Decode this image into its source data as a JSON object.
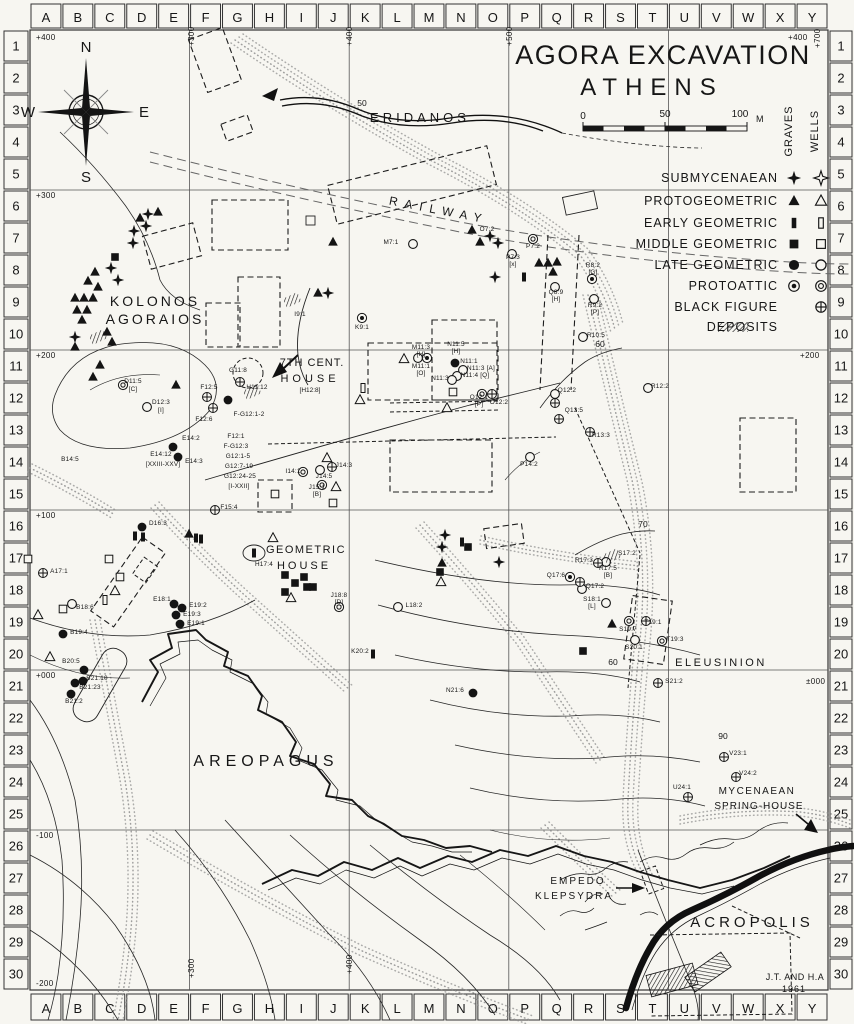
{
  "title": {
    "line1": "AGORA EXCAVATION",
    "line2": "ATHENS"
  },
  "credit": {
    "line1": "J.T. AND H.A",
    "line2": "1961"
  },
  "scale_bar": {
    "t0": "0",
    "t50": "50",
    "t100": "100",
    "unit": "M"
  },
  "compass": {
    "n": "N",
    "s": "S",
    "e": "E",
    "w": "W"
  },
  "grid": {
    "columns": [
      "A",
      "B",
      "C",
      "D",
      "E",
      "F",
      "G",
      "H",
      "I",
      "J",
      "K",
      "L",
      "M",
      "N",
      "O",
      "P",
      "Q",
      "R",
      "S",
      "T",
      "U",
      "V",
      "W",
      "X",
      "Y"
    ],
    "rows": [
      "1",
      "2",
      "3",
      "4",
      "5",
      "6",
      "7",
      "8",
      "9",
      "10",
      "11",
      "12",
      "13",
      "14",
      "15",
      "16",
      "17",
      "18",
      "19",
      "20",
      "21",
      "22",
      "23",
      "24",
      "25",
      "26",
      "27",
      "28",
      "29",
      "30"
    ]
  },
  "legend": {
    "col_headers": [
      "GRAVES",
      "WELLS"
    ],
    "rows": [
      {
        "label": "SUBMYCENAEAN",
        "graves": "sm",
        "wells": "smo"
      },
      {
        "label": "PROTOGEOMETRIC",
        "graves": "pg",
        "wells": "pgo"
      },
      {
        "label": "EARLY GEOMETRIC",
        "graves": "eg",
        "wells": "ego"
      },
      {
        "label": "MIDDLE GEOMETRIC",
        "graves": "mg",
        "wells": "mgo"
      },
      {
        "label": "LATE GEOMETRIC",
        "graves": "lg",
        "wells": "lgo"
      },
      {
        "label": "PROTOATTIC",
        "graves": "pa",
        "wells": "pao"
      },
      {
        "label": "BLACK FIGURE",
        "graves": null,
        "wells": "bf"
      },
      {
        "label": "DEPOSITS",
        "graves": "hatch",
        "wells": null
      }
    ]
  },
  "place_labels": [
    {
      "text": "ERIDANOS",
      "x": 420,
      "y": 122,
      "size": 13,
      "ls": 4
    },
    {
      "text": "RAILWAY",
      "x": 438,
      "y": 214,
      "size": 12,
      "ls": 7,
      "rot": 11
    },
    {
      "text": "KOLONOS",
      "x": 155,
      "y": 306,
      "size": 14,
      "ls": 3
    },
    {
      "text": "AGORAIOS",
      "x": 155,
      "y": 324,
      "size": 14,
      "ls": 3
    },
    {
      "text": "7TH CENT.",
      "x": 312,
      "y": 366,
      "size": 11,
      "ls": 1
    },
    {
      "text": "HOUSE",
      "x": 310,
      "y": 382,
      "size": 11,
      "ls": 4
    },
    {
      "text": "[H12:8]",
      "x": 310,
      "y": 392,
      "size": 6.5,
      "ls": 0
    },
    {
      "text": "GEOMETRIC",
      "x": 306,
      "y": 553,
      "size": 11,
      "ls": 1.5
    },
    {
      "text": "HOUSE",
      "x": 304,
      "y": 569,
      "size": 11,
      "ls": 3
    },
    {
      "text": "AREOPAGUS",
      "x": 266,
      "y": 766,
      "size": 16,
      "ls": 5
    },
    {
      "text": "ELEUSINION",
      "x": 721,
      "y": 666,
      "size": 11,
      "ls": 2.5
    },
    {
      "text": "MYCENAEAN",
      "x": 757,
      "y": 794,
      "size": 10,
      "ls": 1.5
    },
    {
      "text": "SPRING-HOUSE",
      "x": 759,
      "y": 809,
      "size": 10,
      "ls": 1
    },
    {
      "text": "EMPEDO",
      "x": 578,
      "y": 884,
      "size": 10,
      "ls": 2
    },
    {
      "text": "KLEPSYDRA",
      "x": 574,
      "y": 899,
      "size": 10,
      "ls": 2
    },
    {
      "text": "ACROPOLIS",
      "x": 752,
      "y": 927,
      "size": 15,
      "ls": 4
    },
    {
      "text": "GRAVES",
      "x": 792,
      "y": 131,
      "size": 11,
      "ls": 1,
      "rot": -90
    },
    {
      "text": "WELLS",
      "x": 818,
      "y": 131,
      "size": 11,
      "ls": 1,
      "rot": -90
    }
  ],
  "point_labels": [
    [
      "D11:5",
      133,
      383
    ],
    [
      "[C]",
      133,
      391
    ],
    [
      "D12:3",
      161,
      404
    ],
    [
      "[I]",
      161,
      412
    ],
    [
      "B14:5",
      70,
      461
    ],
    [
      "E14:2",
      191,
      440
    ],
    [
      "E14:12",
      161,
      456
    ],
    [
      "[XXIII-XXV]",
      163,
      466
    ],
    [
      "E14:3",
      194,
      463
    ],
    [
      "F12:5",
      209,
      389
    ],
    [
      "F12:6",
      204,
      421
    ],
    [
      "F-G12:1-2",
      249,
      416
    ],
    [
      "G11:8",
      238,
      372
    ],
    [
      "F12:1",
      236,
      438
    ],
    [
      "F-G12:3",
      236,
      448
    ],
    [
      "G12:1-5",
      238,
      458
    ],
    [
      "G12:7-19",
      239,
      468
    ],
    [
      "G12:24-25",
      240,
      478
    ],
    [
      "[I-XXII]",
      239,
      488
    ],
    [
      "F15:4",
      229,
      509
    ],
    [
      "H11:12",
      257,
      389
    ],
    [
      "I14:1",
      293,
      473
    ],
    [
      "J14:5",
      324,
      478
    ],
    [
      "J14:3",
      344,
      467
    ],
    [
      "J15:1",
      317,
      489
    ],
    [
      "[B]",
      317,
      496
    ],
    [
      "D16:3",
      158,
      525
    ],
    [
      "H17:4",
      264,
      566
    ],
    [
      "J18:8",
      339,
      597
    ],
    [
      "[D]",
      339,
      604
    ],
    [
      "E18:1",
      162,
      601
    ],
    [
      "E19:2",
      198,
      607
    ],
    [
      "E19:3",
      192,
      616
    ],
    [
      "E19:1",
      196,
      625
    ],
    [
      "K20:2",
      360,
      653
    ],
    [
      "B18:6",
      85,
      609
    ],
    [
      "A17:1",
      59,
      573
    ],
    [
      "B19:4",
      79,
      634
    ],
    [
      "B20:5",
      71,
      663
    ],
    [
      "B21:10",
      97,
      680
    ],
    [
      "B21:23",
      90,
      689
    ],
    [
      "B21:2",
      74,
      703
    ],
    [
      "L18:2",
      414,
      607
    ],
    [
      "N21:6",
      455,
      692
    ],
    [
      "K9:1",
      362,
      329
    ],
    [
      "I9:1",
      300,
      316
    ],
    [
      "M7:1",
      391,
      244
    ],
    [
      "O7:2",
      487,
      231
    ],
    [
      "P7:2",
      533,
      248
    ],
    [
      "P7:3",
      513,
      259
    ],
    [
      "[x]",
      513,
      266
    ],
    [
      "M11:3",
      421,
      349
    ],
    [
      "[H]",
      421,
      356
    ],
    [
      "N11:5",
      456,
      346
    ],
    [
      "[H]",
      456,
      353
    ],
    [
      "M11:1",
      421,
      368
    ],
    [
      "[O]",
      421,
      375
    ],
    [
      "N11:1",
      469,
      363
    ],
    [
      "N11:3 [A]",
      481,
      370
    ],
    [
      "N11:4 [Q]",
      475,
      377
    ],
    [
      "N11:3",
      440,
      380
    ],
    [
      "O12:1",
      479,
      399
    ],
    [
      "[P]",
      479,
      406
    ],
    [
      "O12:2",
      499,
      404
    ],
    [
      "Q8:9",
      556,
      294
    ],
    [
      "[H]",
      556,
      301
    ],
    [
      "R8:2",
      593,
      267
    ],
    [
      "[G]",
      593,
      274
    ],
    [
      "R9:2",
      595,
      307
    ],
    [
      "[P]",
      595,
      314
    ],
    [
      "R10:5",
      596,
      337
    ],
    [
      "R12:2",
      660,
      388
    ],
    [
      "Q12:2",
      567,
      392
    ],
    [
      "Q13:5",
      574,
      412
    ],
    [
      "R13:3",
      601,
      437
    ],
    [
      "P14:2",
      529,
      466
    ],
    [
      "S17:2",
      627,
      555
    ],
    [
      "R17:3",
      584,
      562
    ],
    [
      "R17:5",
      608,
      570
    ],
    [
      "[B]",
      608,
      577
    ],
    [
      "Q17:6",
      556,
      577
    ],
    [
      "Q17:2",
      595,
      588
    ],
    [
      "S18:1",
      592,
      601
    ],
    [
      "[L]",
      592,
      608
    ],
    [
      "S19:7",
      628,
      631
    ],
    [
      "T19:1",
      653,
      624
    ],
    [
      "T19:3",
      675,
      641
    ],
    [
      "S20:1",
      634,
      649
    ],
    [
      "S21:2",
      674,
      683
    ],
    [
      "V23:1",
      738,
      755
    ],
    [
      "V24:2",
      748,
      775
    ],
    [
      "U24:1",
      682,
      789
    ]
  ],
  "contour_labels": [
    [
      "50",
      362,
      106
    ],
    [
      "60",
      600,
      347
    ],
    [
      "70",
      643,
      527
    ],
    [
      "60",
      613,
      665
    ],
    [
      "90",
      723,
      739
    ]
  ],
  "elevation_labels": [
    {
      "text": "+400",
      "x": 36,
      "y": 40
    },
    {
      "text": "+300",
      "x": 36,
      "y": 198
    },
    {
      "text": "+200",
      "x": 36,
      "y": 358
    },
    {
      "text": "+100",
      "x": 36,
      "y": 518
    },
    {
      "text": "+000",
      "x": 36,
      "y": 678
    },
    {
      "text": "-100",
      "x": 36,
      "y": 838
    },
    {
      "text": "-200",
      "x": 36,
      "y": 986
    },
    {
      "text": "+400",
      "x": 788,
      "y": 40
    },
    {
      "text": "+200",
      "x": 800,
      "y": 358
    },
    {
      "text": "±000",
      "x": 806,
      "y": 684
    },
    {
      "text": "+300",
      "x": 194,
      "y": 46,
      "rot": -90
    },
    {
      "text": "+400",
      "x": 352,
      "y": 46,
      "rot": -90
    },
    {
      "text": "+500",
      "x": 512,
      "y": 46,
      "rot": -90
    },
    {
      "text": "+700",
      "x": 820,
      "y": 48,
      "rot": -90
    },
    {
      "text": "+300",
      "x": 194,
      "y": 978,
      "rot": -90
    },
    {
      "text": "+400",
      "x": 352,
      "y": 974,
      "rot": -90
    }
  ],
  "symbols": [
    [
      "sm",
      148,
      214
    ],
    [
      "sm",
      146,
      226
    ],
    [
      "sm",
      134,
      231
    ],
    [
      "sm",
      133,
      243
    ],
    [
      "sm",
      111,
      268
    ],
    [
      "sm",
      118,
      280
    ],
    [
      "sm",
      75,
      337
    ],
    [
      "sm",
      328,
      293
    ],
    [
      "sm",
      490,
      236
    ],
    [
      "sm",
      498,
      243
    ],
    [
      "sm",
      495,
      277
    ],
    [
      "sm",
      445,
      535
    ],
    [
      "sm",
      442,
      547
    ],
    [
      "sm",
      499,
      562
    ],
    [
      "pg",
      158,
      212
    ],
    [
      "pg",
      140,
      218
    ],
    [
      "pg",
      95,
      272
    ],
    [
      "pg",
      88,
      281
    ],
    [
      "pg",
      98,
      287
    ],
    [
      "pg",
      75,
      298
    ],
    [
      "pg",
      84,
      298
    ],
    [
      "pg",
      93,
      298
    ],
    [
      "pg",
      77,
      310
    ],
    [
      "pg",
      87,
      310
    ],
    [
      "pg",
      82,
      320
    ],
    [
      "pg",
      107,
      332
    ],
    [
      "pg",
      112,
      342
    ],
    [
      "pg",
      75,
      347
    ],
    [
      "pg",
      100,
      365
    ],
    [
      "pg",
      93,
      377
    ],
    [
      "pg",
      176,
      385
    ],
    [
      "pg",
      318,
      293
    ],
    [
      "pg",
      333,
      242
    ],
    [
      "pg",
      472,
      230
    ],
    [
      "pg",
      480,
      242
    ],
    [
      "pg",
      539,
      263
    ],
    [
      "pg",
      548,
      263
    ],
    [
      "pg",
      557,
      262
    ],
    [
      "pg",
      553,
      272
    ],
    [
      "pg",
      442,
      563
    ],
    [
      "pg",
      612,
      624
    ],
    [
      "pg",
      189,
      534
    ],
    [
      "pgo",
      404,
      359
    ],
    [
      "pgo",
      447,
      408
    ],
    [
      "pgo",
      327,
      458
    ],
    [
      "pgo",
      336,
      487
    ],
    [
      "pgo",
      360,
      400
    ],
    [
      "pgo",
      273,
      538
    ],
    [
      "pgo",
      291,
      598
    ],
    [
      "pgo",
      115,
      591
    ],
    [
      "pgo",
      38,
      615
    ],
    [
      "pgo",
      50,
      657
    ],
    [
      "pgo",
      441,
      582
    ],
    [
      "eg",
      462,
      542
    ],
    [
      "eg",
      524,
      277
    ],
    [
      "eg",
      135,
      536
    ],
    [
      "eg",
      143,
      537
    ],
    [
      "eg",
      196,
      538
    ],
    [
      "eg",
      201,
      539
    ],
    [
      "eg",
      373,
      654
    ],
    [
      "eg",
      254,
      553
    ],
    [
      "ego",
      363,
      388
    ],
    [
      "ego",
      105,
      600
    ],
    [
      "mg",
      115,
      257
    ],
    [
      "mg",
      468,
      547
    ],
    [
      "mg",
      440,
      572
    ],
    [
      "mg",
      583,
      651
    ],
    [
      "mg",
      285,
      575
    ],
    [
      "mg",
      295,
      583
    ],
    [
      "mg",
      304,
      577
    ],
    [
      "mg",
      307,
      587
    ],
    [
      "mg",
      313,
      587
    ],
    [
      "mg",
      285,
      592
    ],
    [
      "mgo",
      453,
      392
    ],
    [
      "mgo",
      333,
      503
    ],
    [
      "mgo",
      275,
      494
    ],
    [
      "mgo",
      109,
      559
    ],
    [
      "mgo",
      120,
      577
    ],
    [
      "mgo",
      63,
      609
    ],
    [
      "mgo",
      28,
      559
    ],
    [
      "lg",
      228,
      400
    ],
    [
      "lg",
      455,
      363
    ],
    [
      "lg",
      142,
      527
    ],
    [
      "lg",
      174,
      604
    ],
    [
      "lg",
      182,
      608
    ],
    [
      "lg",
      176,
      615
    ],
    [
      "lg",
      180,
      624
    ],
    [
      "lg",
      63,
      634
    ],
    [
      "lg",
      84,
      670
    ],
    [
      "lg",
      83,
      681
    ],
    [
      "lg",
      75,
      683
    ],
    [
      "lg",
      71,
      694
    ],
    [
      "lg",
      473,
      693
    ],
    [
      "lg",
      173,
      447
    ],
    [
      "lg",
      178,
      457
    ],
    [
      "lgo",
      147,
      407
    ],
    [
      "lgo",
      413,
      244
    ],
    [
      "lgo",
      512,
      254
    ],
    [
      "lgo",
      555,
      287
    ],
    [
      "lgo",
      594,
      299
    ],
    [
      "lgo",
      583,
      337
    ],
    [
      "lgo",
      648,
      388
    ],
    [
      "lgo",
      555,
      394
    ],
    [
      "lgo",
      530,
      457
    ],
    [
      "lgo",
      463,
      370
    ],
    [
      "lgo",
      457,
      376
    ],
    [
      "lgo",
      452,
      380
    ],
    [
      "lgo",
      320,
      470
    ],
    [
      "lgo",
      398,
      607
    ],
    [
      "lgo",
      606,
      603
    ],
    [
      "lgo",
      582,
      589
    ],
    [
      "lgo",
      635,
      640
    ],
    [
      "lgo",
      606,
      562
    ],
    [
      "lgo",
      72,
      604
    ],
    [
      "lgo",
      418,
      358
    ],
    [
      "pa",
      362,
      318
    ],
    [
      "pa",
      592,
      279
    ],
    [
      "pa",
      427,
      358
    ],
    [
      "pa",
      570,
      577
    ],
    [
      "pao",
      533,
      239
    ],
    [
      "pao",
      303,
      472
    ],
    [
      "pao",
      322,
      485
    ],
    [
      "pao",
      629,
      621
    ],
    [
      "pao",
      662,
      641
    ],
    [
      "pao",
      339,
      607
    ],
    [
      "pao",
      123,
      385
    ],
    [
      "pao",
      482,
      394
    ],
    [
      "bf",
      240,
      382
    ],
    [
      "bf",
      207,
      397
    ],
    [
      "bf",
      213,
      408
    ],
    [
      "bf",
      215,
      510
    ],
    [
      "bf",
      332,
      467
    ],
    [
      "bf",
      43,
      573
    ],
    [
      "bf",
      598,
      563
    ],
    [
      "bf",
      580,
      582
    ],
    [
      "bf",
      559,
      419
    ],
    [
      "bf",
      555,
      403
    ],
    [
      "bf",
      590,
      432
    ],
    [
      "bf",
      646,
      621
    ],
    [
      "bf",
      658,
      683
    ],
    [
      "bf",
      724,
      757
    ],
    [
      "bf",
      736,
      777
    ],
    [
      "bf",
      688,
      797
    ],
    [
      "bf",
      492,
      394
    ],
    [
      "dep",
      98,
      337
    ],
    [
      "dep",
      292,
      300
    ],
    [
      "dep",
      252,
      392
    ],
    [
      "dep",
      612,
      556
    ]
  ]
}
